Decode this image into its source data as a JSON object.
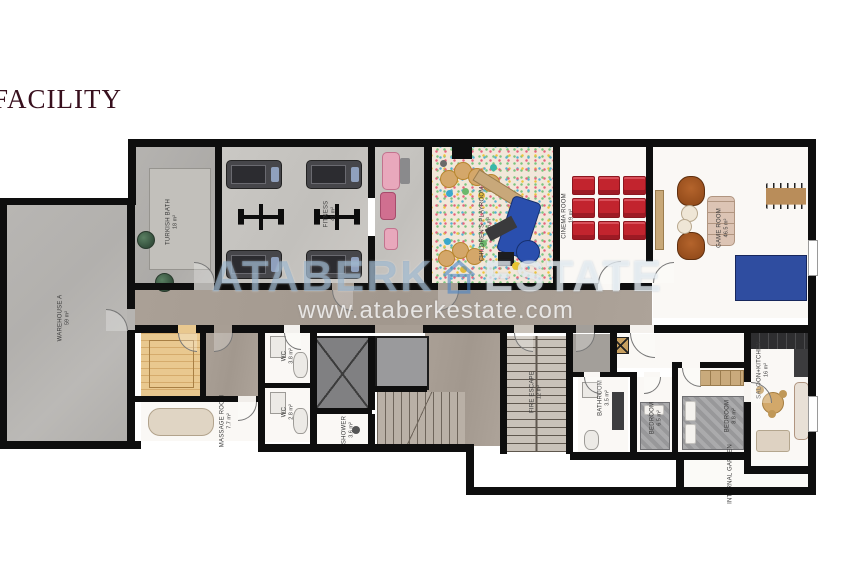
{
  "page": {
    "title": "FACILITY"
  },
  "watermark": {
    "brand_left": "ATABERK",
    "brand_right": "ESTATE",
    "icon": "house-icon",
    "url": "www.ataberkestate.com"
  },
  "colors": {
    "wall": "#0e0e0e",
    "title_text": "#38101e",
    "corridor_floor": "#a89e94",
    "concrete_floor": "#b5b3b0",
    "cinema_seat_red": "#c2242e",
    "pingpong_blue": "#2f4da0",
    "sauna_wood": "#e0bc82",
    "watermark_blue": "#8fabc7",
    "watermark_white": "#eef3f7"
  },
  "rooms": [
    {
      "label": "WAREHOUSE A",
      "area": "59 m²"
    },
    {
      "label": "TURKISH BATH",
      "area": "18 m²"
    },
    {
      "label": "FITNESS",
      "area": "41 m²"
    },
    {
      "label": "CHILDREN'S PLAYROOM",
      "area": "36 m²"
    },
    {
      "label": "CINEMA ROOM",
      "area": "19 m²"
    },
    {
      "label": "GAME ROOM",
      "area": "46.5 m²"
    },
    {
      "label": "MASSAGE ROOM",
      "area": "7.7 m²"
    },
    {
      "label": "WC",
      "area": "3.8 m²"
    },
    {
      "label": "WC",
      "area": "2.8 m²"
    },
    {
      "label": "SHOWER",
      "area": "3.6 m²"
    },
    {
      "label": "FIRE ESCAPE",
      "area": "12 m²"
    },
    {
      "label": "BATHROOM",
      "area": "3.5 m²"
    },
    {
      "label": "BEDROOM",
      "area": "6.5 m²"
    },
    {
      "label": "BEDROOM",
      "area": "8.8 m²"
    },
    {
      "label": "SALOON+KITCHEN",
      "area": "16 m²"
    },
    {
      "label": "INTERNAL GARDEN",
      "area": ""
    }
  ]
}
